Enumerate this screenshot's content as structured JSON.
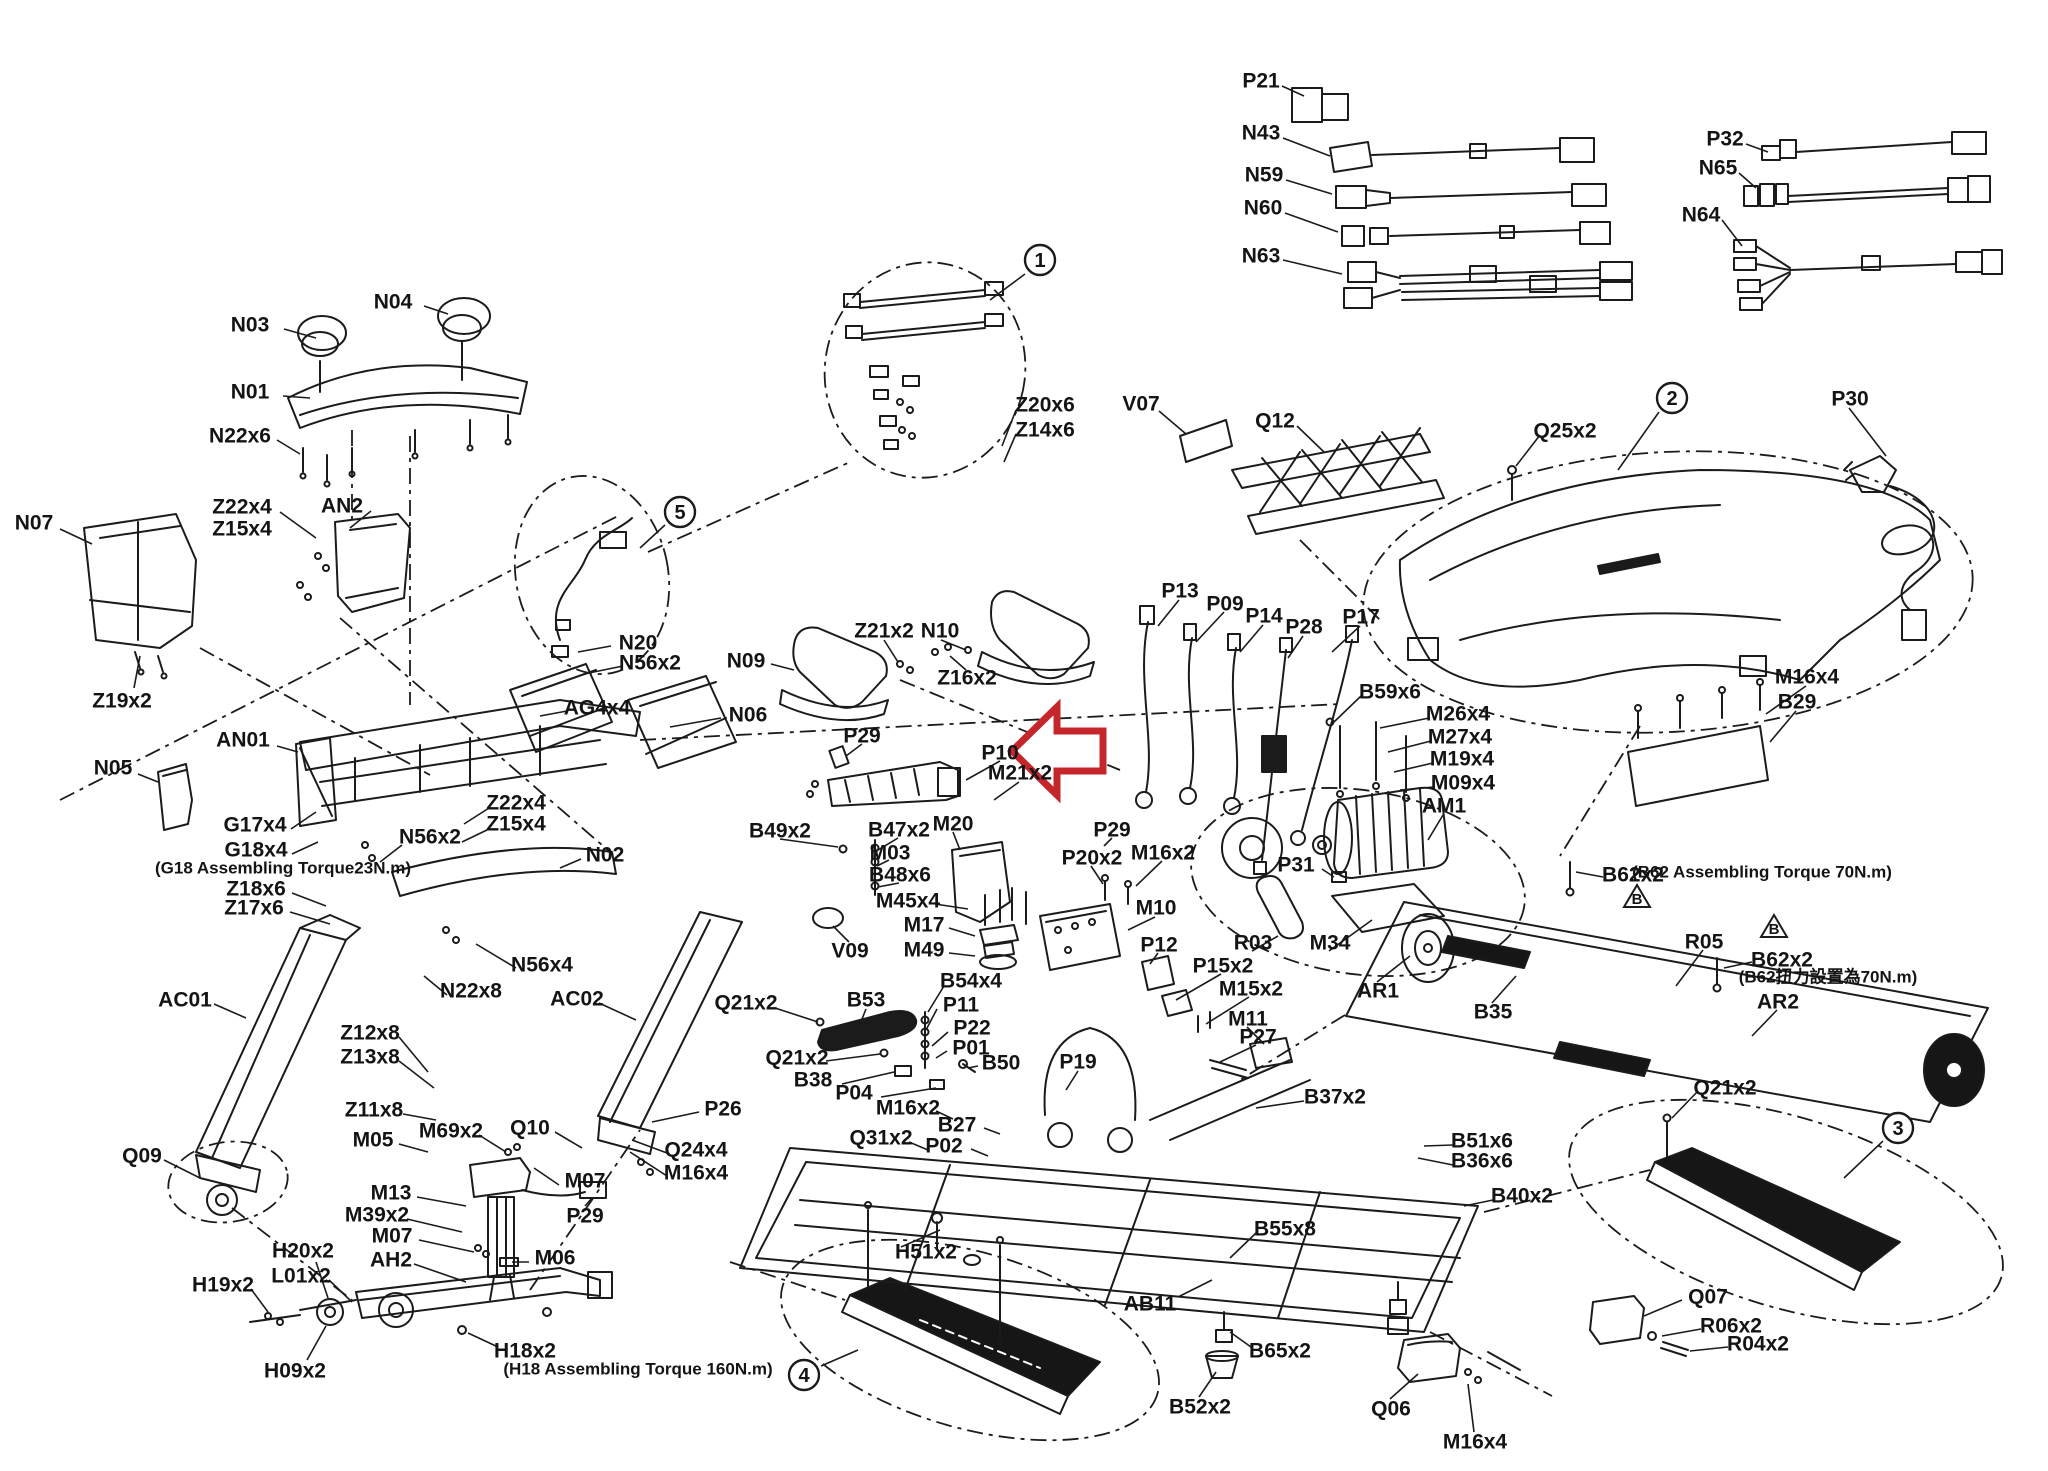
{
  "page": {
    "kind": "treadmill exploded parts diagram",
    "background": "#ffffff",
    "ink_color": "#1b1b1b",
    "arrow_color": "#c4262c"
  },
  "labels": [
    {
      "text": "N03",
      "x": 250,
      "y": 325
    },
    {
      "text": "N04",
      "x": 393,
      "y": 302
    },
    {
      "text": "N01",
      "x": 250,
      "y": 392
    },
    {
      "text": "N22x6",
      "x": 240,
      "y": 436
    },
    {
      "text": "Z22x4",
      "x": 242,
      "y": 507
    },
    {
      "text": "Z15x4",
      "x": 242,
      "y": 529
    },
    {
      "text": "AN2",
      "x": 342,
      "y": 506
    },
    {
      "text": "N07",
      "x": 34,
      "y": 523
    },
    {
      "text": "Z19x2",
      "x": 122,
      "y": 701
    },
    {
      "text": "N05",
      "x": 113,
      "y": 768
    },
    {
      "text": "AN01",
      "x": 243,
      "y": 740
    },
    {
      "text": "G17x4",
      "x": 255,
      "y": 825
    },
    {
      "text": "G18x4",
      "x": 256,
      "y": 850
    },
    {
      "text": "(G18 Assembling Torque23N.m)",
      "x": 283,
      "y": 868,
      "small": true
    },
    {
      "text": "Z18x6",
      "x": 256,
      "y": 889
    },
    {
      "text": "Z17x6",
      "x": 254,
      "y": 908
    },
    {
      "text": "N56x2",
      "x": 430,
      "y": 837
    },
    {
      "text": "Z22x4",
      "x": 516,
      "y": 803
    },
    {
      "text": "Z15x4",
      "x": 516,
      "y": 824
    },
    {
      "text": "N02",
      "x": 605,
      "y": 855
    },
    {
      "text": "N56x4",
      "x": 542,
      "y": 965
    },
    {
      "text": "N22x8",
      "x": 471,
      "y": 991
    },
    {
      "text": "AC01",
      "x": 185,
      "y": 1000
    },
    {
      "text": "AC02",
      "x": 577,
      "y": 999
    },
    {
      "text": "Z12x8",
      "x": 370,
      "y": 1033
    },
    {
      "text": "Z13x8",
      "x": 370,
      "y": 1057
    },
    {
      "text": "Z11x8",
      "x": 374,
      "y": 1110
    },
    {
      "text": "M05",
      "x": 373,
      "y": 1140
    },
    {
      "text": "M69x2",
      "x": 451,
      "y": 1131
    },
    {
      "text": "Q10",
      "x": 530,
      "y": 1128
    },
    {
      "text": "Q09",
      "x": 142,
      "y": 1156
    },
    {
      "text": "M07",
      "x": 585,
      "y": 1181
    },
    {
      "text": "M13",
      "x": 391,
      "y": 1193
    },
    {
      "text": "M39x2",
      "x": 377,
      "y": 1215
    },
    {
      "text": "M07",
      "x": 392,
      "y": 1236
    },
    {
      "text": "AH2",
      "x": 391,
      "y": 1260
    },
    {
      "text": "H20x2",
      "x": 303,
      "y": 1251
    },
    {
      "text": "L01x2",
      "x": 301,
      "y": 1276
    },
    {
      "text": "H19x2",
      "x": 223,
      "y": 1285
    },
    {
      "text": "H09x2",
      "x": 295,
      "y": 1371
    },
    {
      "text": "P29",
      "x": 585,
      "y": 1216
    },
    {
      "text": "M06",
      "x": 555,
      "y": 1258
    },
    {
      "text": "H18x2",
      "x": 525,
      "y": 1351
    },
    {
      "text": "(H18 Assembling Torque 160N.m)",
      "x": 638,
      "y": 1369,
      "small": true
    },
    {
      "text": "N20",
      "x": 638,
      "y": 643
    },
    {
      "text": "N56x2",
      "x": 650,
      "y": 663
    },
    {
      "text": "AG4x4",
      "x": 597,
      "y": 708
    },
    {
      "text": "N06",
      "x": 748,
      "y": 715
    },
    {
      "text": "N09",
      "x": 746,
      "y": 661
    },
    {
      "text": "Z21x2",
      "x": 884,
      "y": 631
    },
    {
      "text": "N10",
      "x": 940,
      "y": 631
    },
    {
      "text": "Z16x2",
      "x": 967,
      "y": 678
    },
    {
      "text": "Z20x6",
      "x": 1045,
      "y": 405
    },
    {
      "text": "Z14x6",
      "x": 1045,
      "y": 430
    },
    {
      "text": "V07",
      "x": 1141,
      "y": 404
    },
    {
      "text": "Q12",
      "x": 1275,
      "y": 421
    },
    {
      "text": "Q25x2",
      "x": 1565,
      "y": 431
    },
    {
      "text": "P30",
      "x": 1850,
      "y": 399
    },
    {
      "text": "P21",
      "x": 1261,
      "y": 81
    },
    {
      "text": "N43",
      "x": 1261,
      "y": 133
    },
    {
      "text": "N59",
      "x": 1264,
      "y": 175
    },
    {
      "text": "N60",
      "x": 1263,
      "y": 208
    },
    {
      "text": "N63",
      "x": 1261,
      "y": 256
    },
    {
      "text": "P32",
      "x": 1725,
      "y": 139
    },
    {
      "text": "N65",
      "x": 1718,
      "y": 168
    },
    {
      "text": "N64",
      "x": 1701,
      "y": 215
    },
    {
      "text": "P13",
      "x": 1180,
      "y": 591
    },
    {
      "text": "P09",
      "x": 1225,
      "y": 604
    },
    {
      "text": "P14",
      "x": 1264,
      "y": 616
    },
    {
      "text": "P28",
      "x": 1304,
      "y": 627
    },
    {
      "text": "P17",
      "x": 1361,
      "y": 617
    },
    {
      "text": "P29",
      "x": 862,
      "y": 736
    },
    {
      "text": "P10",
      "x": 1000,
      "y": 753
    },
    {
      "text": "M21x2",
      "x": 1020,
      "y": 773
    },
    {
      "text": "P29",
      "x": 1112,
      "y": 830
    },
    {
      "text": "B49x2",
      "x": 780,
      "y": 831
    },
    {
      "text": "B47x2",
      "x": 899,
      "y": 830
    },
    {
      "text": "M03",
      "x": 890,
      "y": 853
    },
    {
      "text": "B48x6",
      "x": 900,
      "y": 875
    },
    {
      "text": "M20",
      "x": 953,
      "y": 824
    },
    {
      "text": "M45x4",
      "x": 908,
      "y": 901
    },
    {
      "text": "M17",
      "x": 924,
      "y": 925
    },
    {
      "text": "M49",
      "x": 924,
      "y": 950
    },
    {
      "text": "V09",
      "x": 850,
      "y": 951
    },
    {
      "text": "B54x4",
      "x": 971,
      "y": 981
    },
    {
      "text": "P11",
      "x": 961,
      "y": 1005
    },
    {
      "text": "P22",
      "x": 972,
      "y": 1028
    },
    {
      "text": "P01",
      "x": 971,
      "y": 1048
    },
    {
      "text": "B50",
      "x": 1001,
      "y": 1063
    },
    {
      "text": "P19",
      "x": 1078,
      "y": 1062
    },
    {
      "text": "Q21x2",
      "x": 746,
      "y": 1003
    },
    {
      "text": "B53",
      "x": 866,
      "y": 1000
    },
    {
      "text": "Q21x2",
      "x": 797,
      "y": 1058
    },
    {
      "text": "B38",
      "x": 813,
      "y": 1080
    },
    {
      "text": "P04",
      "x": 854,
      "y": 1093
    },
    {
      "text": "M16x2",
      "x": 908,
      "y": 1108
    },
    {
      "text": "B27",
      "x": 957,
      "y": 1125
    },
    {
      "text": "Q31x2",
      "x": 881,
      "y": 1138
    },
    {
      "text": "P02",
      "x": 944,
      "y": 1146
    },
    {
      "text": "P26",
      "x": 723,
      "y": 1109
    },
    {
      "text": "Q24x4",
      "x": 696,
      "y": 1150
    },
    {
      "text": "M16x4",
      "x": 696,
      "y": 1173
    },
    {
      "text": "P20x2",
      "x": 1092,
      "y": 858
    },
    {
      "text": "M16x2",
      "x": 1163,
      "y": 853
    },
    {
      "text": "M10",
      "x": 1156,
      "y": 908
    },
    {
      "text": "P12",
      "x": 1159,
      "y": 945
    },
    {
      "text": "R03",
      "x": 1253,
      "y": 943
    },
    {
      "text": "M34",
      "x": 1330,
      "y": 943
    },
    {
      "text": "P31",
      "x": 1296,
      "y": 865
    },
    {
      "text": "B59x6",
      "x": 1390,
      "y": 692
    },
    {
      "text": "M26x4",
      "x": 1458,
      "y": 714
    },
    {
      "text": "M27x4",
      "x": 1460,
      "y": 737
    },
    {
      "text": "M19x4",
      "x": 1462,
      "y": 759
    },
    {
      "text": "M09x4",
      "x": 1463,
      "y": 783
    },
    {
      "text": "AM1",
      "x": 1444,
      "y": 806
    },
    {
      "text": "P15x2",
      "x": 1223,
      "y": 966
    },
    {
      "text": "M15x2",
      "x": 1251,
      "y": 989
    },
    {
      "text": "M11",
      "x": 1248,
      "y": 1019
    },
    {
      "text": "P27",
      "x": 1258,
      "y": 1037
    },
    {
      "text": "AR1",
      "x": 1378,
      "y": 991
    },
    {
      "text": "B35",
      "x": 1493,
      "y": 1012
    },
    {
      "text": "M16x4",
      "x": 1807,
      "y": 677
    },
    {
      "text": "B29",
      "x": 1797,
      "y": 702
    },
    {
      "text": "B62x2",
      "x": 1633,
      "y": 875
    },
    {
      "text": "(B62 Assembling Torque 70N.m)",
      "x": 1762,
      "y": 872,
      "small": true
    },
    {
      "text": "R05",
      "x": 1704,
      "y": 942
    },
    {
      "text": "B62x2",
      "x": 1782,
      "y": 960
    },
    {
      "text": "(B62扭力設置為70N.m)",
      "x": 1828,
      "y": 977,
      "small": true
    },
    {
      "text": "AR2",
      "x": 1778,
      "y": 1002
    },
    {
      "text": "Q21x2",
      "x": 1725,
      "y": 1088
    },
    {
      "text": "Q07",
      "x": 1708,
      "y": 1297
    },
    {
      "text": "R06x2",
      "x": 1731,
      "y": 1326
    },
    {
      "text": "R04x2",
      "x": 1758,
      "y": 1344
    },
    {
      "text": "B37x2",
      "x": 1335,
      "y": 1097
    },
    {
      "text": "B51x6",
      "x": 1482,
      "y": 1141
    },
    {
      "text": "B36x6",
      "x": 1482,
      "y": 1161
    },
    {
      "text": "B40x2",
      "x": 1522,
      "y": 1196
    },
    {
      "text": "B55x8",
      "x": 1285,
      "y": 1229
    },
    {
      "text": "H51x2",
      "x": 926,
      "y": 1252
    },
    {
      "text": "AB11",
      "x": 1150,
      "y": 1304
    },
    {
      "text": "B65x2",
      "x": 1280,
      "y": 1351
    },
    {
      "text": "B52x2",
      "x": 1200,
      "y": 1407
    },
    {
      "text": "Q06",
      "x": 1391,
      "y": 1409
    },
    {
      "text": "M16x4",
      "x": 1475,
      "y": 1442
    }
  ],
  "callouts": [
    {
      "num": "1",
      "x": 1040,
      "y": 260
    },
    {
      "num": "2",
      "x": 1672,
      "y": 398
    },
    {
      "num": "3",
      "x": 1898,
      "y": 1128
    },
    {
      "num": "4",
      "x": 804,
      "y": 1375
    },
    {
      "num": "5",
      "x": 680,
      "y": 512
    }
  ],
  "warning_triangles": [
    {
      "letter": "B",
      "x": 1637,
      "y": 898
    },
    {
      "letter": "B",
      "x": 1774,
      "y": 928
    }
  ],
  "red_arrow": {
    "color": "#c4262c",
    "points": "1012,751 1057,707 1057,731 1103,731 1103,771 1057,771 1057,795"
  }
}
